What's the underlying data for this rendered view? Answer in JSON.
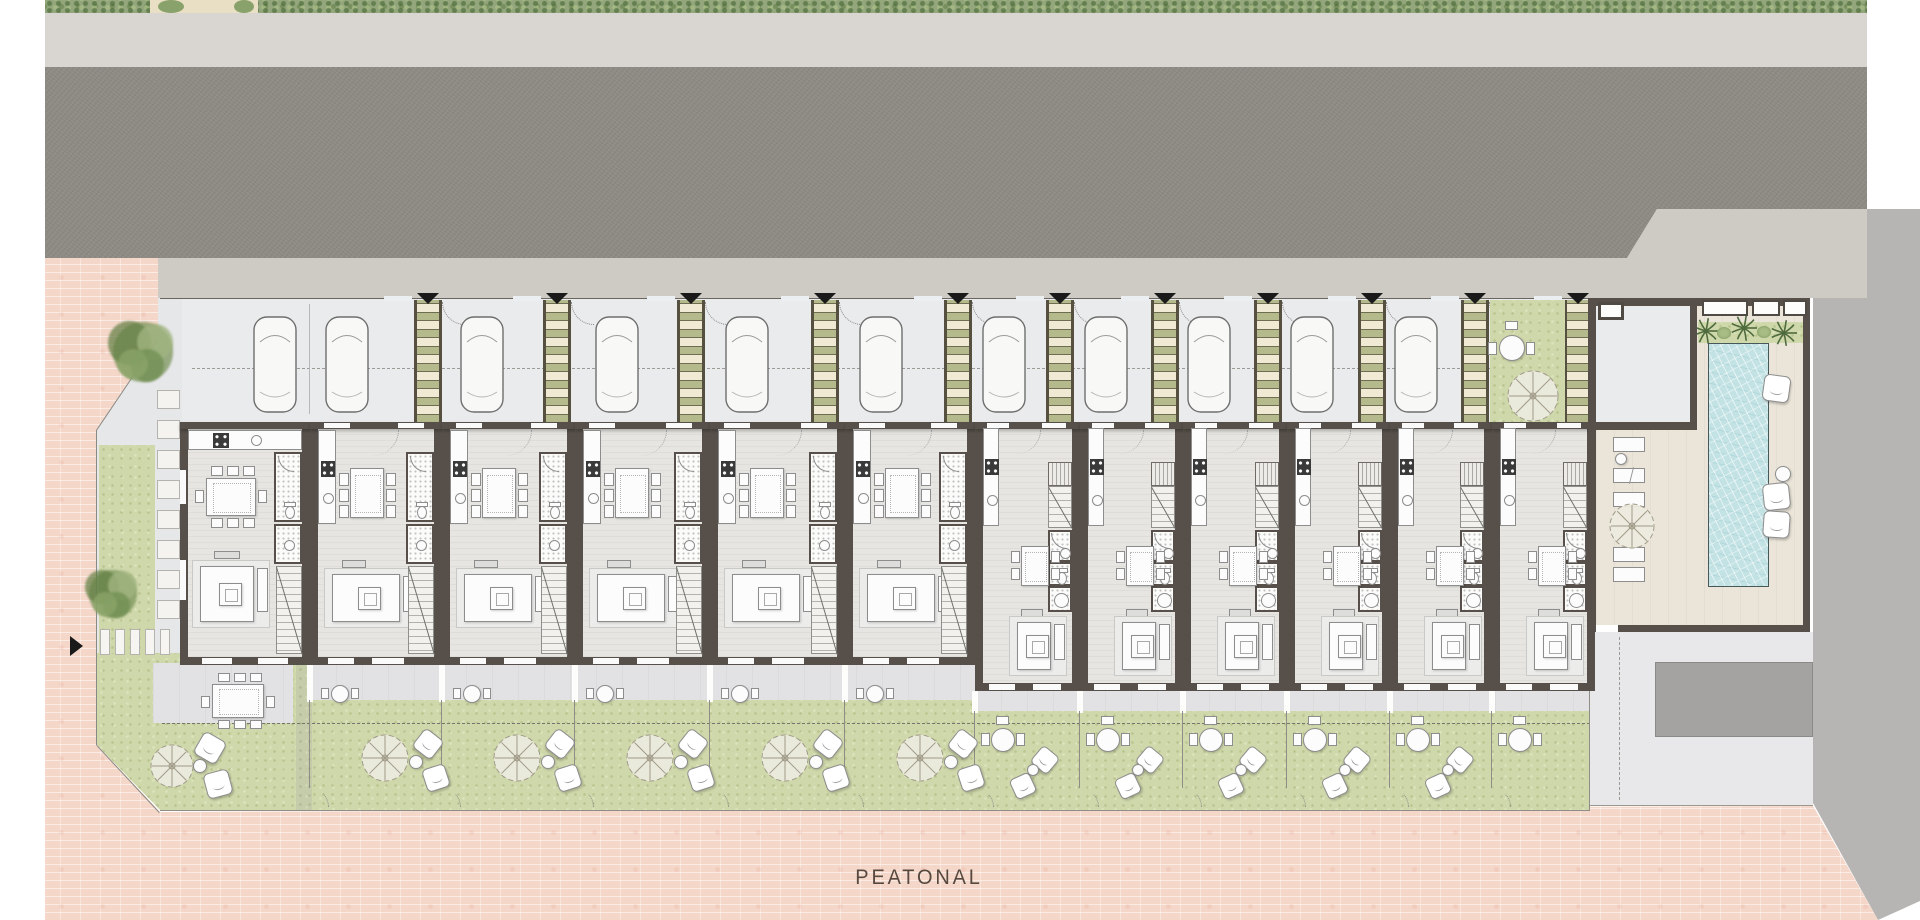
{
  "labels": {
    "peatonal": "PEATONAL"
  },
  "palette": {
    "road": "#8e8a84",
    "sidewalk": "#d9d5d0",
    "sidewalk_low": "#cecbc5",
    "plaza_pink": "#f4d7c9",
    "lawn": "#cfd8ab",
    "hedge": "#93a67c",
    "wall": "#57504a",
    "floor": "#e6e5e1",
    "terrace": "#e2e2e4",
    "parking": "#eaebed",
    "deck": "#ebe5d9",
    "pool_water": "#c3e2e4",
    "gray_band": "#b7b5b3",
    "utility_pad": "#a5a3a1",
    "walkway": "#e8e8ea",
    "pergola_base": "#b5ba8c",
    "pergola_slat": "#f0ead4",
    "marker": "#1a1a1a",
    "text": "#57493f"
  },
  "site": {
    "canvas": {
      "w": 1920,
      "h": 920
    },
    "hedge": {
      "x": 45,
      "x2": 1867,
      "y": 0,
      "h": 13,
      "gap_x": 150,
      "gap_w": 108
    },
    "sidewalk_top": {
      "x": 45,
      "x2": 1867,
      "y": 13,
      "h": 54
    },
    "road_poly": [
      [
        45,
        67
      ],
      [
        1867,
        67
      ],
      [
        1867,
        209
      ],
      [
        1657,
        209
      ],
      [
        1627,
        258
      ],
      [
        45,
        258
      ]
    ],
    "sidewalk_low_poly": [
      [
        45,
        258
      ],
      [
        1627,
        258
      ],
      [
        1657,
        209
      ],
      [
        1867,
        209
      ],
      [
        1867,
        298
      ],
      [
        45,
        298
      ]
    ],
    "gray_right_poly": [
      [
        1813,
        298
      ],
      [
        1867,
        298
      ],
      [
        1867,
        209
      ],
      [
        1920,
        209
      ],
      [
        1920,
        901
      ],
      [
        1878,
        920
      ],
      [
        1813,
        803
      ]
    ],
    "plaza_poly": [
      [
        45,
        258
      ],
      [
        158,
        258
      ],
      [
        158,
        340
      ],
      [
        97,
        430
      ],
      [
        97,
        745
      ],
      [
        160,
        812
      ],
      [
        1813,
        806
      ],
      [
        1878,
        920
      ],
      [
        45,
        920
      ]
    ],
    "left_strip_poly": [
      [
        97,
        430
      ],
      [
        158,
        340
      ],
      [
        158,
        298
      ],
      [
        182,
        298
      ],
      [
        182,
        653
      ],
      [
        97,
        653
      ]
    ],
    "left_lawn": {
      "x": 99,
      "y": 445,
      "w": 56,
      "h": 208
    },
    "corner_lawn_poly": [
      [
        97,
        653
      ],
      [
        298,
        653
      ],
      [
        298,
        810
      ],
      [
        160,
        810
      ],
      [
        97,
        745
      ]
    ],
    "stepping_stones": {
      "x": 157,
      "w": 23,
      "y0": 390,
      "count": 8,
      "pitch": 30,
      "h": 19
    },
    "crosswalk": {
      "y": 629,
      "h": 26,
      "bar_w": 10,
      "xs": [
        100,
        115,
        130,
        145,
        160
      ]
    },
    "entry_marker_left": {
      "x": 70,
      "y": 636
    },
    "trees": [
      {
        "cx": 143,
        "cy": 352,
        "r": 30
      },
      {
        "cx": 113,
        "cy": 594,
        "r": 24
      }
    ],
    "parking_band": {
      "x": 182,
      "x2": 1590,
      "y": 298,
      "h": 124
    },
    "parking_dash_y": 368,
    "property_line_y": 298,
    "walls_x": [
      180,
      310,
      442,
      575,
      710,
      845,
      975,
      1080,
      1183,
      1287,
      1390,
      1492,
      1595
    ],
    "unit_types": [
      "corner",
      "wide",
      "wide",
      "wide",
      "wide",
      "wide",
      "narrow",
      "narrow",
      "narrow",
      "narrow",
      "narrow",
      "narrow"
    ],
    "building": {
      "top_y": 422,
      "wall_t": 8,
      "bottom_wide_y": 657,
      "bottom_narrow_y": 683
    },
    "pergolas_x": [
      428,
      557,
      691,
      825,
      958,
      1060,
      1165,
      1268,
      1372,
      1475,
      1578
    ],
    "entry_triangles": {
      "xs": [
        428,
        557,
        691,
        825,
        958,
        1060,
        1165,
        1268,
        1372,
        1475,
        1578
      ],
      "y": 293
    },
    "cars_x": [
      275,
      347,
      482,
      617,
      747,
      881,
      1004,
      1106,
      1209,
      1312,
      1416,
      1651
    ],
    "car": {
      "y": 316,
      "w": 44,
      "h": 97
    },
    "patio": {
      "x": 1490,
      "x2": 1565,
      "y": 300,
      "y2": 422,
      "table": {
        "cx": 1512,
        "cy": 348,
        "r": 13
      },
      "parasol": {
        "cx": 1533,
        "cy": 396,
        "r": 26
      }
    },
    "terrace": {
      "wide_y": 663,
      "wide_y2": 702,
      "narrow_y": 691,
      "narrow_y2": 713,
      "corner": {
        "x": 153,
        "y": 663,
        "w": 140,
        "h": 60
      }
    },
    "garden": {
      "wide_y": 700,
      "narrow_y": 711,
      "bottom_y": 810,
      "dash_y": 723,
      "hedge_divider": {
        "x": 296,
        "y": 665,
        "w": 16,
        "h": 145
      }
    },
    "corner_garden": {
      "parasol": {
        "cx": 172,
        "cy": 766,
        "r": 22
      },
      "cushions": [
        [
          210,
          748,
          30
        ],
        [
          218,
          784,
          -15
        ]
      ],
      "side_table": {
        "cx": 200,
        "cy": 766,
        "r": 7
      },
      "big_table": {
        "x": 212,
        "y": 684,
        "w": 52,
        "h": 34
      }
    },
    "pool_block": {
      "deck": {
        "x": 1596,
        "y": 306,
        "x2": 1803,
        "y2": 625
      },
      "parking_notch": {
        "x": 1596,
        "y": 306,
        "x2": 1690,
        "y2": 422
      },
      "walls": [
        [
          1588,
          298,
          1810,
          306
        ],
        [
          1803,
          298,
          1810,
          632
        ],
        [
          1618,
          625,
          1810,
          632
        ],
        [
          1588,
          306,
          1596,
          632
        ],
        [
          1595,
          422,
          1697,
          430
        ],
        [
          1690,
          306,
          1697,
          430
        ]
      ],
      "windows": [
        [
          1702,
          300,
          46,
          16
        ],
        [
          1752,
          300,
          28,
          16
        ],
        [
          1783,
          300,
          24,
          16
        ]
      ],
      "utility_box": {
        "x": 1598,
        "y": 302,
        "w": 26,
        "h": 18
      },
      "planting": {
        "x": 1698,
        "y": 322,
        "w": 106,
        "h": 21
      },
      "palms": [
        [
          1706,
          331
        ],
        [
          1744,
          328
        ],
        [
          1784,
          333
        ]
      ],
      "shrubs": [
        [
          1724,
          333
        ],
        [
          1764,
          332
        ]
      ],
      "pool": {
        "x": 1708,
        "y": 343,
        "w": 61,
        "h": 244
      },
      "loungers": [
        [
          1613,
          437
        ],
        [
          1613,
          468
        ],
        [
          1613,
          492
        ],
        [
          1613,
          547
        ],
        [
          1613,
          567
        ]
      ],
      "lounger_size": {
        "w": 32,
        "h": 15
      },
      "side_table": {
        "cx": 1621,
        "cy": 459,
        "r": 6
      },
      "parasol": {
        "cx": 1632,
        "cy": 526,
        "r": 23
      },
      "cushions": [
        [
          1776,
          388,
          8
        ],
        [
          1776,
          496,
          -6
        ],
        [
          1776,
          524,
          4
        ]
      ],
      "round_table": {
        "cx": 1783,
        "cy": 474,
        "r": 8
      }
    },
    "walkway": {
      "x": 1590,
      "y": 632,
      "x2": 1813,
      "y2": 805,
      "dash_x": 1620
    },
    "utility_pad": {
      "x": 1655,
      "y": 662,
      "x2": 1813,
      "y2": 737
    }
  }
}
